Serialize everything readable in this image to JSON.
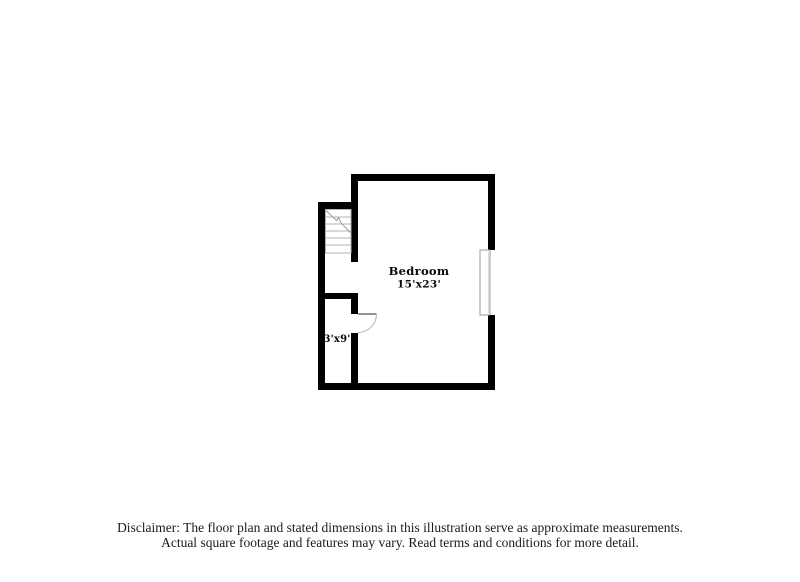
{
  "floor_plan": {
    "room": {
      "label": "Bedroom",
      "dimensions": "15'x23'"
    },
    "closet": {
      "dimensions": "3'x9'"
    },
    "symbols": {
      "stairs": "stairs-symbol",
      "door": "door-swing-symbol",
      "window": "window-symbol"
    },
    "colors": {
      "wall": "#000000",
      "fixture_line": "#b3b3b3",
      "door_leaf": "#555555",
      "label_text": "#0a0a0a"
    }
  },
  "disclaimer": {
    "line1": "Disclaimer: The floor plan and stated dimensions in this illustration serve as approximate measurements.",
    "line2": "Actual square footage and features may vary. Read terms and conditions for more detail."
  }
}
